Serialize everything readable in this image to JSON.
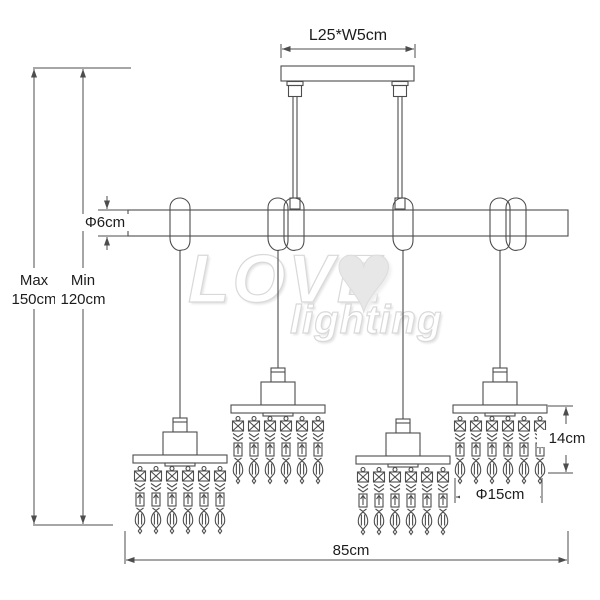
{
  "drawing": {
    "canopy_dimension": "L25*W5cm",
    "bar_diameter": "Φ6cm",
    "height_max_label": "Max",
    "height_max_value": "150cm",
    "height_min_label": "Min",
    "height_min_value": "120cm",
    "shade_height": "14cm",
    "shade_diameter": "Φ15cm",
    "bar_length": "85cm",
    "pendant_count": 4,
    "strands_per_pendant": 6
  },
  "watermark": {
    "brand_line1": "LOVE",
    "brand_line2": "lighting",
    "heart_icon": "♥"
  },
  "style": {
    "line_color": "#4d4d4d",
    "label_color": "#1c1c1c",
    "watermark_gray": "#dddddd",
    "background": "#ffffff"
  }
}
